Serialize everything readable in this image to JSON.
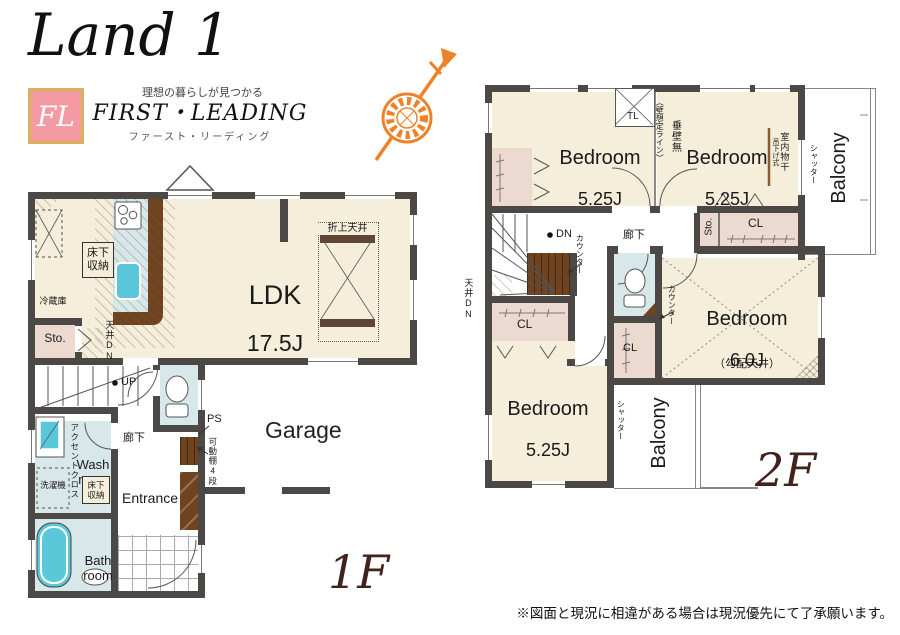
{
  "brand": {
    "logo": "Land 1",
    "badge": "FL",
    "tagline": "理想の暮らしが見つかる",
    "company_en": "FIRST・LEADING",
    "company_kana": "ファースト・リーディング"
  },
  "floor1": {
    "label": "1F",
    "ldk": "LDK",
    "ldk_size": "17.5J",
    "raised_ceiling": "折上天井",
    "floor_storage": "床下収納",
    "fridge": "冷蔵庫",
    "storage": "Sto.",
    "ceiling_dn": "天井DN",
    "up": "UP",
    "hallway": "廊下",
    "ps": "PS",
    "shelf": "可動棚4段",
    "accent_cloth": "アクセントクロス",
    "washroom": "Wash room",
    "washer": "洗濯機",
    "bathroom": "Bath room",
    "entrance": "Entrance",
    "garage": "Garage"
  },
  "floor2": {
    "label": "2F",
    "bedroom": "Bedroom",
    "size_525": "5.25J",
    "size_60": "6.0J",
    "tl": "TL",
    "no_hanging_wall": "垂壁無",
    "wall_line": "（壁想定ライン）",
    "indoor_drying": "室内物干",
    "hanging_type": "吊下げ式",
    "shutter": "シャッター",
    "balcony": "Balcony",
    "storage": "Sto.",
    "closet": "CL",
    "hallway": "廊下",
    "dn": "DN",
    "counter": "カウンター",
    "ceiling_dn": "天井DN",
    "sloped_ceiling": "（勾配天井）"
  },
  "footer": {
    "disclaimer": "※図面と現況に相違がある場合は現況優先にて了承願います。"
  }
}
